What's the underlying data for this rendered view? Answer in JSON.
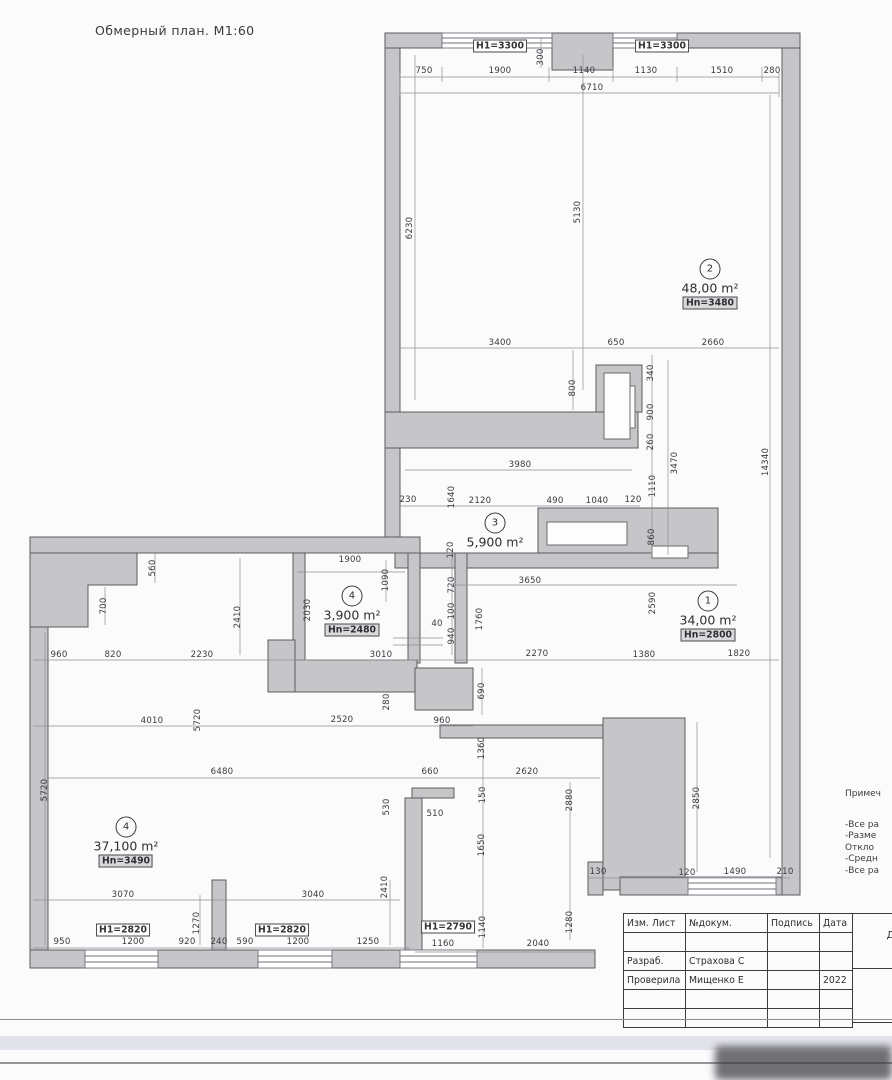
{
  "title": "Обмерный план. М1:60",
  "plan": {
    "rooms": [
      {
        "number": "2",
        "area": "48,00 m²",
        "height": "Hn=3480",
        "x": 710,
        "y": 284
      },
      {
        "number": "3",
        "area": "5,900 m²",
        "height": "",
        "x": 495,
        "y": 531
      },
      {
        "number": "4",
        "area": "3,900 m²",
        "height": "Hn=2480",
        "x": 352,
        "y": 611
      },
      {
        "number": "1",
        "area": "34,00 m²",
        "height": "Hn=2800",
        "x": 708,
        "y": 616
      },
      {
        "number": "4",
        "area": "37,100 m²",
        "height": "Hn=3490",
        "x": 126,
        "y": 842
      }
    ],
    "wall_labels": [
      {
        "t": "H1=3300",
        "x": 500,
        "y": 46
      },
      {
        "t": "H1=3300",
        "x": 662,
        "y": 46
      },
      {
        "t": "H1=2820",
        "x": 123,
        "y": 930
      },
      {
        "t": "H1=2820",
        "x": 282,
        "y": 930
      },
      {
        "t": "H1=2790",
        "x": 448,
        "y": 927
      }
    ],
    "dimensions": [
      {
        "t": "750",
        "x": 424,
        "y": 71
      },
      {
        "t": "1900",
        "x": 500,
        "y": 71
      },
      {
        "t": "1140",
        "x": 584,
        "y": 71
      },
      {
        "t": "1130",
        "x": 646,
        "y": 71
      },
      {
        "t": "1510",
        "x": 722,
        "y": 71
      },
      {
        "t": "280",
        "x": 772,
        "y": 71
      },
      {
        "t": "6710",
        "x": 592,
        "y": 88
      },
      {
        "t": "300",
        "x": 541,
        "y": 57,
        "r": 1
      },
      {
        "t": "6230",
        "x": 410,
        "y": 228,
        "r": 1
      },
      {
        "t": "5130",
        "x": 578,
        "y": 212,
        "r": 1
      },
      {
        "t": "3400",
        "x": 500,
        "y": 343
      },
      {
        "t": "650",
        "x": 616,
        "y": 343
      },
      {
        "t": "2660",
        "x": 713,
        "y": 343
      },
      {
        "t": "800",
        "x": 573,
        "y": 388,
        "r": 1
      },
      {
        "t": "340",
        "x": 651,
        "y": 373,
        "r": 1
      },
      {
        "t": "900",
        "x": 651,
        "y": 412,
        "r": 1
      },
      {
        "t": "260",
        "x": 651,
        "y": 442,
        "r": 1
      },
      {
        "t": "3470",
        "x": 675,
        "y": 463,
        "r": 1
      },
      {
        "t": "1110",
        "x": 653,
        "y": 486,
        "r": 1
      },
      {
        "t": "14340",
        "x": 766,
        "y": 462,
        "r": 1
      },
      {
        "t": "3980",
        "x": 520,
        "y": 465
      },
      {
        "t": "230",
        "x": 408,
        "y": 500
      },
      {
        "t": "1640",
        "x": 452,
        "y": 497,
        "r": 1
      },
      {
        "t": "2120",
        "x": 480,
        "y": 501
      },
      {
        "t": "490",
        "x": 555,
        "y": 501
      },
      {
        "t": "1040",
        "x": 597,
        "y": 501
      },
      {
        "t": "120",
        "x": 633,
        "y": 500
      },
      {
        "t": "860",
        "x": 652,
        "y": 537,
        "r": 1
      },
      {
        "t": "120",
        "x": 451,
        "y": 550,
        "r": 1
      },
      {
        "t": "3650",
        "x": 530,
        "y": 581
      },
      {
        "t": "720",
        "x": 452,
        "y": 585,
        "r": 1
      },
      {
        "t": "1900",
        "x": 350,
        "y": 560
      },
      {
        "t": "1090",
        "x": 386,
        "y": 580,
        "r": 1
      },
      {
        "t": "2030",
        "x": 308,
        "y": 610,
        "r": 1
      },
      {
        "t": "100",
        "x": 452,
        "y": 611,
        "r": 1
      },
      {
        "t": "40",
        "x": 437,
        "y": 624
      },
      {
        "t": "940",
        "x": 452,
        "y": 636,
        "r": 1
      },
      {
        "t": "1760",
        "x": 480,
        "y": 619,
        "r": 1
      },
      {
        "t": "3010",
        "x": 381,
        "y": 655
      },
      {
        "t": "2590",
        "x": 653,
        "y": 603,
        "r": 1
      },
      {
        "t": "2270",
        "x": 537,
        "y": 654
      },
      {
        "t": "1380",
        "x": 644,
        "y": 655
      },
      {
        "t": "1820",
        "x": 739,
        "y": 654
      },
      {
        "t": "560",
        "x": 153,
        "y": 568,
        "r": 1
      },
      {
        "t": "700",
        "x": 104,
        "y": 606,
        "r": 1
      },
      {
        "t": "2410",
        "x": 238,
        "y": 617,
        "r": 1
      },
      {
        "t": "960",
        "x": 59,
        "y": 655
      },
      {
        "t": "820",
        "x": 113,
        "y": 655
      },
      {
        "t": "2230",
        "x": 202,
        "y": 655
      },
      {
        "t": "280",
        "x": 387,
        "y": 702,
        "r": 1
      },
      {
        "t": "690",
        "x": 482,
        "y": 691,
        "r": 1
      },
      {
        "t": "4010",
        "x": 152,
        "y": 721
      },
      {
        "t": "5720",
        "x": 198,
        "y": 720,
        "r": 1
      },
      {
        "t": "2520",
        "x": 342,
        "y": 720
      },
      {
        "t": "960",
        "x": 442,
        "y": 721
      },
      {
        "t": "1360",
        "x": 482,
        "y": 748,
        "r": 1
      },
      {
        "t": "6480",
        "x": 222,
        "y": 772
      },
      {
        "t": "660",
        "x": 430,
        "y": 772
      },
      {
        "t": "2620",
        "x": 527,
        "y": 772
      },
      {
        "t": "530",
        "x": 387,
        "y": 807,
        "r": 1
      },
      {
        "t": "150",
        "x": 483,
        "y": 795,
        "r": 1
      },
      {
        "t": "510",
        "x": 435,
        "y": 814
      },
      {
        "t": "1650",
        "x": 482,
        "y": 845,
        "r": 1
      },
      {
        "t": "2880",
        "x": 570,
        "y": 800,
        "r": 1
      },
      {
        "t": "2850",
        "x": 697,
        "y": 798,
        "r": 1
      },
      {
        "t": "5720",
        "x": 45,
        "y": 790,
        "r": 1
      },
      {
        "t": "130",
        "x": 598,
        "y": 872
      },
      {
        "t": "120",
        "x": 687,
        "y": 873
      },
      {
        "t": "1490",
        "x": 735,
        "y": 872
      },
      {
        "t": "210",
        "x": 785,
        "y": 872
      },
      {
        "t": "3070",
        "x": 123,
        "y": 895
      },
      {
        "t": "3040",
        "x": 313,
        "y": 895
      },
      {
        "t": "2410",
        "x": 385,
        "y": 887,
        "r": 1
      },
      {
        "t": "1270",
        "x": 197,
        "y": 923,
        "r": 1
      },
      {
        "t": "950",
        "x": 62,
        "y": 942
      },
      {
        "t": "1200",
        "x": 133,
        "y": 942
      },
      {
        "t": "920",
        "x": 187,
        "y": 942
      },
      {
        "t": "240",
        "x": 219,
        "y": 942
      },
      {
        "t": "590",
        "x": 245,
        "y": 942
      },
      {
        "t": "1200",
        "x": 298,
        "y": 942
      },
      {
        "t": "1250",
        "x": 368,
        "y": 942
      },
      {
        "t": "1160",
        "x": 443,
        "y": 944
      },
      {
        "t": "1140",
        "x": 483,
        "y": 927,
        "r": 1
      },
      {
        "t": "2040",
        "x": 538,
        "y": 944
      },
      {
        "t": "1280",
        "x": 570,
        "y": 922,
        "r": 1
      }
    ]
  },
  "notes": {
    "heading": "Примеч",
    "lines": [
      "-Все ра",
      "-Разме",
      " Откло",
      "-Средн",
      "-Все ра"
    ]
  },
  "titleblock": {
    "headers": [
      "Изм. Лист",
      "№докум.",
      "Подпись",
      "Дата"
    ],
    "rows": [
      [
        "",
        "",
        "",
        ""
      ],
      [
        "Разраб.",
        "Страхова С",
        "",
        ""
      ],
      [
        "Проверила",
        "Мищенко Е",
        "",
        "2022"
      ],
      [
        "",
        "",
        "",
        ""
      ],
      [
        "",
        "",
        "",
        ""
      ]
    ],
    "side_label": "ДИЗ",
    "date_value": "2022"
  },
  "colors": {
    "wall_fill": "#c6c6c8",
    "wall_stroke": "#5c5c60",
    "dim_line": "#8f8f96"
  }
}
